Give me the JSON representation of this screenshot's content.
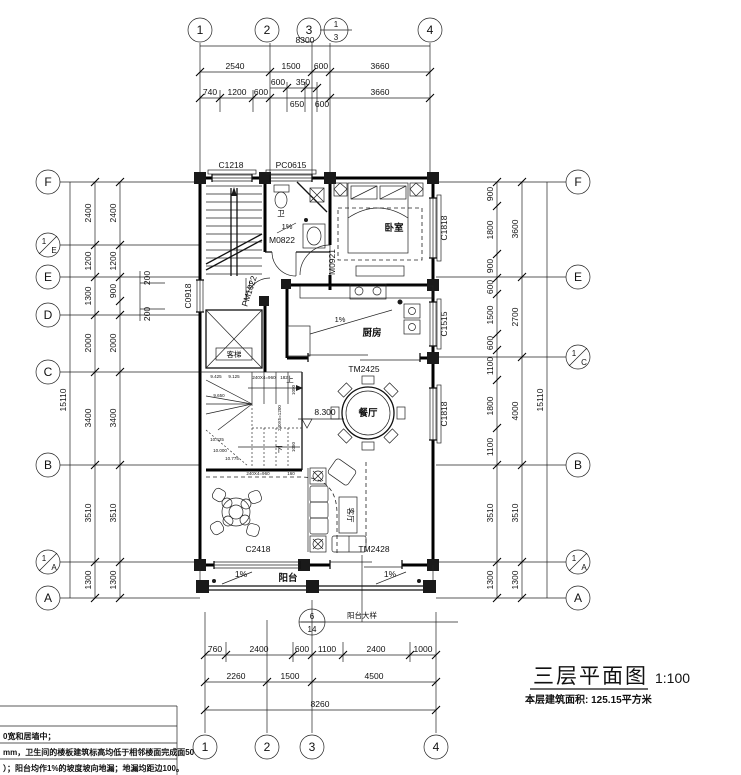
{
  "title_block": {
    "title": "三层平面图",
    "scale": "1:100",
    "area": "本层建筑面积: 125.15平方米"
  },
  "grid": {
    "top": [
      "1",
      "2",
      "3",
      "4"
    ],
    "top_fraction": {
      "num": "1",
      "den": "3"
    },
    "bottom": [
      "1",
      "2",
      "3",
      "4"
    ],
    "left": [
      "F",
      "E",
      "D",
      "C",
      "B",
      "A"
    ],
    "left_frac_e": {
      "num": "1",
      "den": "E"
    },
    "left_frac_a": {
      "num": "1",
      "den": "A"
    },
    "right": [
      "F",
      "E",
      "B",
      "A"
    ],
    "right_frac_c": {
      "num": "1",
      "den": "C"
    },
    "right_frac_a": {
      "num": "1",
      "den": "A"
    }
  },
  "dims": {
    "top_total": "8300",
    "top_row2": [
      "2540",
      "1500",
      "600",
      "3660"
    ],
    "top_row3_upper": [
      "600",
      "350"
    ],
    "top_row3": [
      "740",
      "1200",
      "600",
      "650",
      "600",
      "3660"
    ],
    "bottom_row1": [
      "760",
      "2400",
      "600",
      "1100",
      "2400",
      "1000"
    ],
    "bottom_row2": [
      "2260",
      "1500",
      "4500"
    ],
    "bottom_total": "8260",
    "left_total": "15110",
    "left_outer": [
      "2400",
      "1200",
      "1300",
      "2000",
      "3400",
      "3510",
      "1300"
    ],
    "left_inner": [
      "2400",
      "1200",
      "900",
      "2000",
      "3400",
      "3510",
      "1300"
    ],
    "left_small": [
      "200",
      "200"
    ],
    "right_total": "15110",
    "right_inner": [
      "900",
      "1800",
      "900",
      "600",
      "1500",
      "600",
      "1100",
      "1800",
      "1100",
      "3510",
      "1300"
    ],
    "right_outer": [
      "3600",
      "2700",
      "4000",
      "3510",
      "1300"
    ]
  },
  "openings": {
    "c1218": "C1218",
    "pc0615": "PC0615",
    "c1818_bedroom": "C1818",
    "c0918": "C0918",
    "c1515": "C1515",
    "c1818_dining": "C1818",
    "tm2425": "TM2425",
    "c2418": "C2418",
    "tm2428": "TM2428",
    "m0822": "M0822",
    "m0921": "M0921",
    "pm1022": "PM1022"
  },
  "rooms": {
    "bedroom": "卧室",
    "bathroom": "卫",
    "kitchen": "厨房",
    "dining": "餐厅",
    "living": "客厅",
    "elevator": "客梯",
    "balcony": "阳台"
  },
  "annotations": {
    "level": "8.300",
    "slope": "1%",
    "up": "上",
    "down": "下",
    "stair": [
      "9.425",
      "9.125",
      "240X4=960",
      "182",
      "1050",
      "240X5=1200",
      "1050",
      "9.650",
      "10.425",
      "10.000",
      "10.775",
      "240X4=960",
      "160"
    ]
  },
  "detail": {
    "num": "6",
    "den": "14",
    "label": "阳台大样"
  },
  "notes": {
    "rows": [
      "0宽和居墙中；",
      "mm，卫生间的楼板建筑标高均低于相邻楼面完成面50",
      "）；阳台均作1%的坡度坡向地漏；地漏均距边100。"
    ]
  }
}
